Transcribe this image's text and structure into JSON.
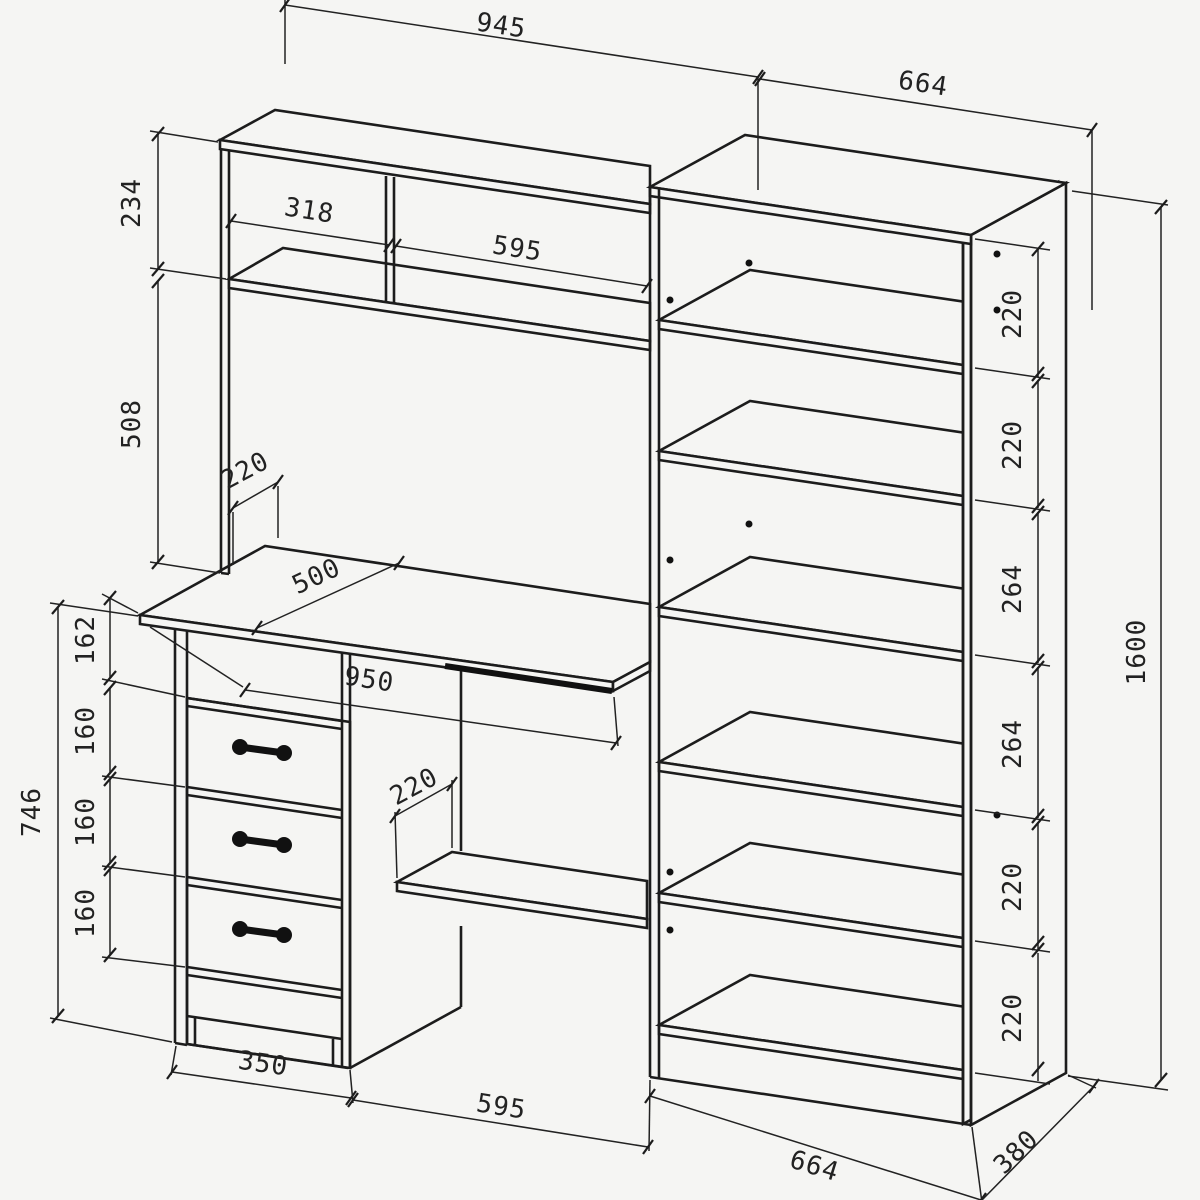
{
  "colors": {
    "background": "#f5f5f3",
    "line": "#1c1c1c",
    "dimension": "#222222"
  },
  "drawing": {
    "top": {
      "hutch_width": "945",
      "bookcase_width": "664"
    },
    "left": {
      "hutch_top_section": "234",
      "hutch_bottom_section": "508",
      "desk_top_to_drawer": "162",
      "drawer_pitch_1": "160",
      "drawer_pitch_2": "160",
      "drawer_pitch_3": "160",
      "desk_height": "746"
    },
    "hutch": {
      "left_cubby_width": "318",
      "right_cubby_width": "595",
      "shelf_depth": "220"
    },
    "desk": {
      "top_depth": "500",
      "top_width": "950",
      "under_shelf_depth": "220"
    },
    "bottom": {
      "pedestal_width": "350",
      "knee_space_width": "595",
      "bookcase_width": "664",
      "bookcase_depth": "380"
    },
    "right": {
      "shelf_space_1": "220",
      "shelf_space_2": "220",
      "shelf_space_3": "264",
      "shelf_space_4": "264",
      "shelf_space_5": "220",
      "shelf_space_6": "220",
      "bookcase_height": "1600"
    }
  }
}
